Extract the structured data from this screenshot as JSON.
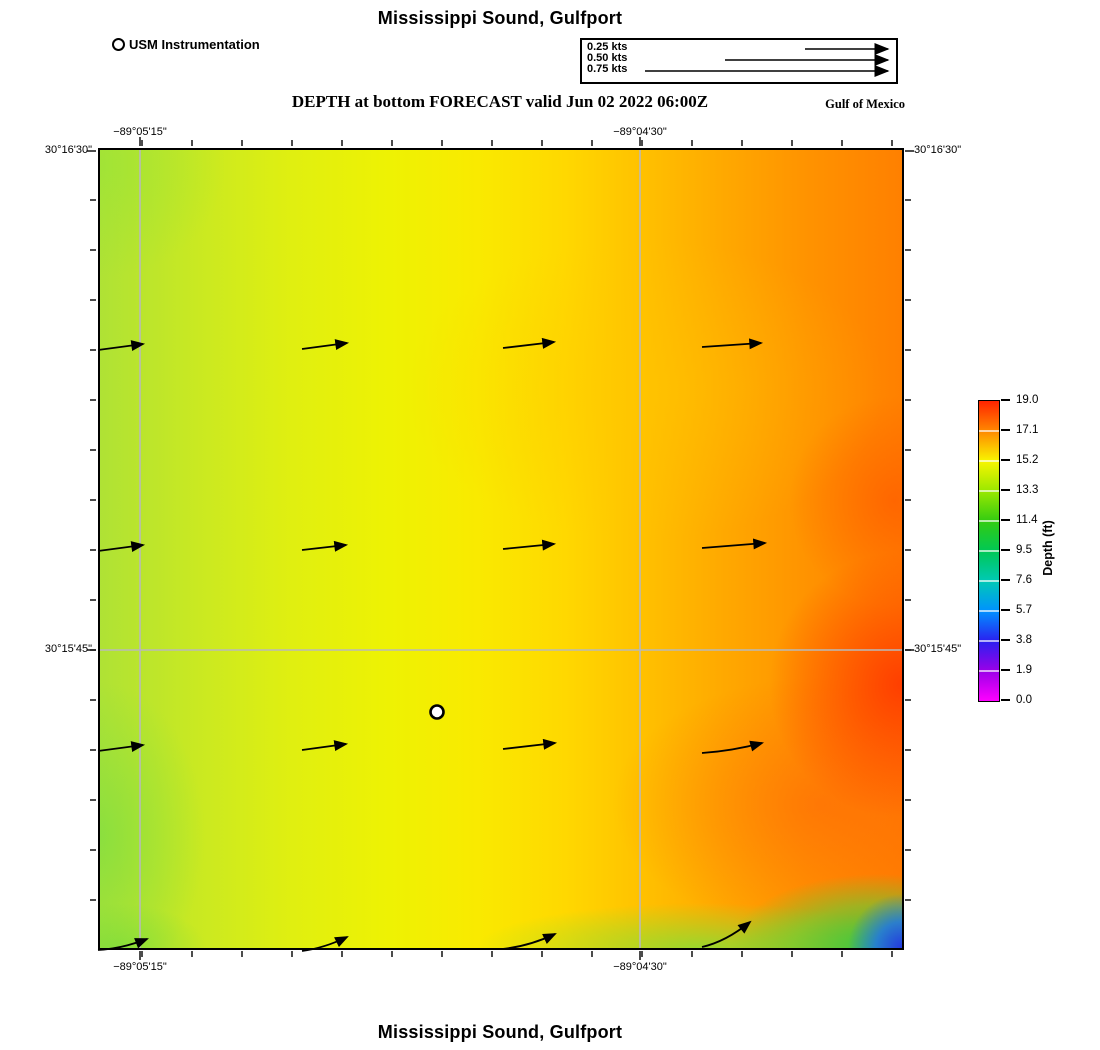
{
  "title_top": "Mississippi Sound, Gulfport",
  "title_bottom": "Mississippi Sound, Gulfport",
  "subtitle": "DEPTH at bottom FORECAST valid Jun 02 2022 06:00Z",
  "region_label": "Gulf of Mexico",
  "instrument_legend": {
    "label": "USM Instrumentation",
    "marker": "open-circle-icon"
  },
  "velocity_legend": {
    "items": [
      {
        "label": "0.25 kts",
        "tail_x": 223,
        "y": 9
      },
      {
        "label": "0.50 kts",
        "tail_x": 143,
        "y": 20
      },
      {
        "label": "0.75 kts",
        "tail_x": 63,
        "y": 31
      }
    ],
    "head_x": 306
  },
  "axes": {
    "top_labels": [
      {
        "text": "−89°05'15\"",
        "x": 140
      },
      {
        "text": "−89°04'30\"",
        "x": 640
      }
    ],
    "bottom_labels": [
      {
        "text": "−89°05'15\"",
        "x": 140
      },
      {
        "text": "−89°04'30\"",
        "x": 640
      }
    ],
    "left_labels": [
      {
        "text": "30°16'30\"",
        "y": 151
      },
      {
        "text": "30°15'45\"",
        "y": 650
      }
    ],
    "right_labels": [
      {
        "text": "30°16'30\"",
        "y": 151
      },
      {
        "text": "30°15'45\"",
        "y": 650
      }
    ],
    "grid_x_abs": [
      140,
      640
    ],
    "grid_y_abs": [
      650
    ],
    "ticks": {
      "minor_x_start": 142,
      "minor_x_spacing": 50,
      "minor_x_count": 16,
      "minor_y_start": 200,
      "minor_y_spacing": 50,
      "minor_y_count": 15,
      "major_x_abs": [
        140,
        640
      ],
      "major_y_abs": [
        151,
        650
      ]
    }
  },
  "colorbar": {
    "label": "Depth (ft)",
    "ticks": [
      "19.0",
      "17.1",
      "15.2",
      "13.3",
      "11.4",
      "9.5",
      "7.6",
      "5.7",
      "3.8",
      "1.9",
      "0.0"
    ],
    "stops": [
      "#ff2400",
      "#ff8800",
      "#f8f500",
      "#9ae800",
      "#33cc11",
      "#00c855",
      "#00c9b5",
      "#0092ff",
      "#2a20f0",
      "#9b00e8",
      "#ff00ff"
    ],
    "tick_spacing_px": 30
  },
  "map": {
    "station": {
      "x": 339,
      "y": 564,
      "label": "USM instrumentation station"
    },
    "arrows": [
      {
        "x1": 0,
        "y1": 202,
        "x2": 45,
        "y2": 196,
        "sag": 0
      },
      {
        "x1": 204,
        "y1": 201,
        "x2": 249,
        "y2": 195,
        "sag": 0
      },
      {
        "x1": 405,
        "y1": 200,
        "x2": 456,
        "y2": 194,
        "sag": 0
      },
      {
        "x1": 604,
        "y1": 199,
        "x2": 663,
        "y2": 195,
        "sag": 0
      },
      {
        "x1": 0,
        "y1": 403,
        "x2": 45,
        "y2": 397,
        "sag": 0
      },
      {
        "x1": 204,
        "y1": 402,
        "x2": 248,
        "y2": 397,
        "sag": 0
      },
      {
        "x1": 405,
        "y1": 401,
        "x2": 456,
        "y2": 396,
        "sag": 0
      },
      {
        "x1": 604,
        "y1": 400,
        "x2": 667,
        "y2": 395,
        "sag": 0
      },
      {
        "x1": 0,
        "y1": 603,
        "x2": 45,
        "y2": 597,
        "sag": 0
      },
      {
        "x1": 204,
        "y1": 602,
        "x2": 248,
        "y2": 596,
        "sag": 0
      },
      {
        "x1": 405,
        "y1": 601,
        "x2": 457,
        "y2": 595,
        "sag": 0
      },
      {
        "x1": 604,
        "y1": 605,
        "x2": 664,
        "y2": 595,
        "sag": 3
      },
      {
        "x1": 0,
        "y1": 802,
        "x2": 49,
        "y2": 791,
        "sag": 4
      },
      {
        "x1": 204,
        "y1": 803,
        "x2": 249,
        "y2": 789,
        "sag": 4
      },
      {
        "x1": 404,
        "y1": 801,
        "x2": 457,
        "y2": 786,
        "sag": 5
      },
      {
        "x1": 604,
        "y1": 799,
        "x2": 652,
        "y2": 774,
        "sag": 7
      }
    ]
  },
  "colors": {
    "grid": "#b9b9b9",
    "vector": "#000000",
    "station_fill": "#ffffff",
    "deep_red": "#ff3700",
    "shallow_blue": "#2438e0"
  }
}
